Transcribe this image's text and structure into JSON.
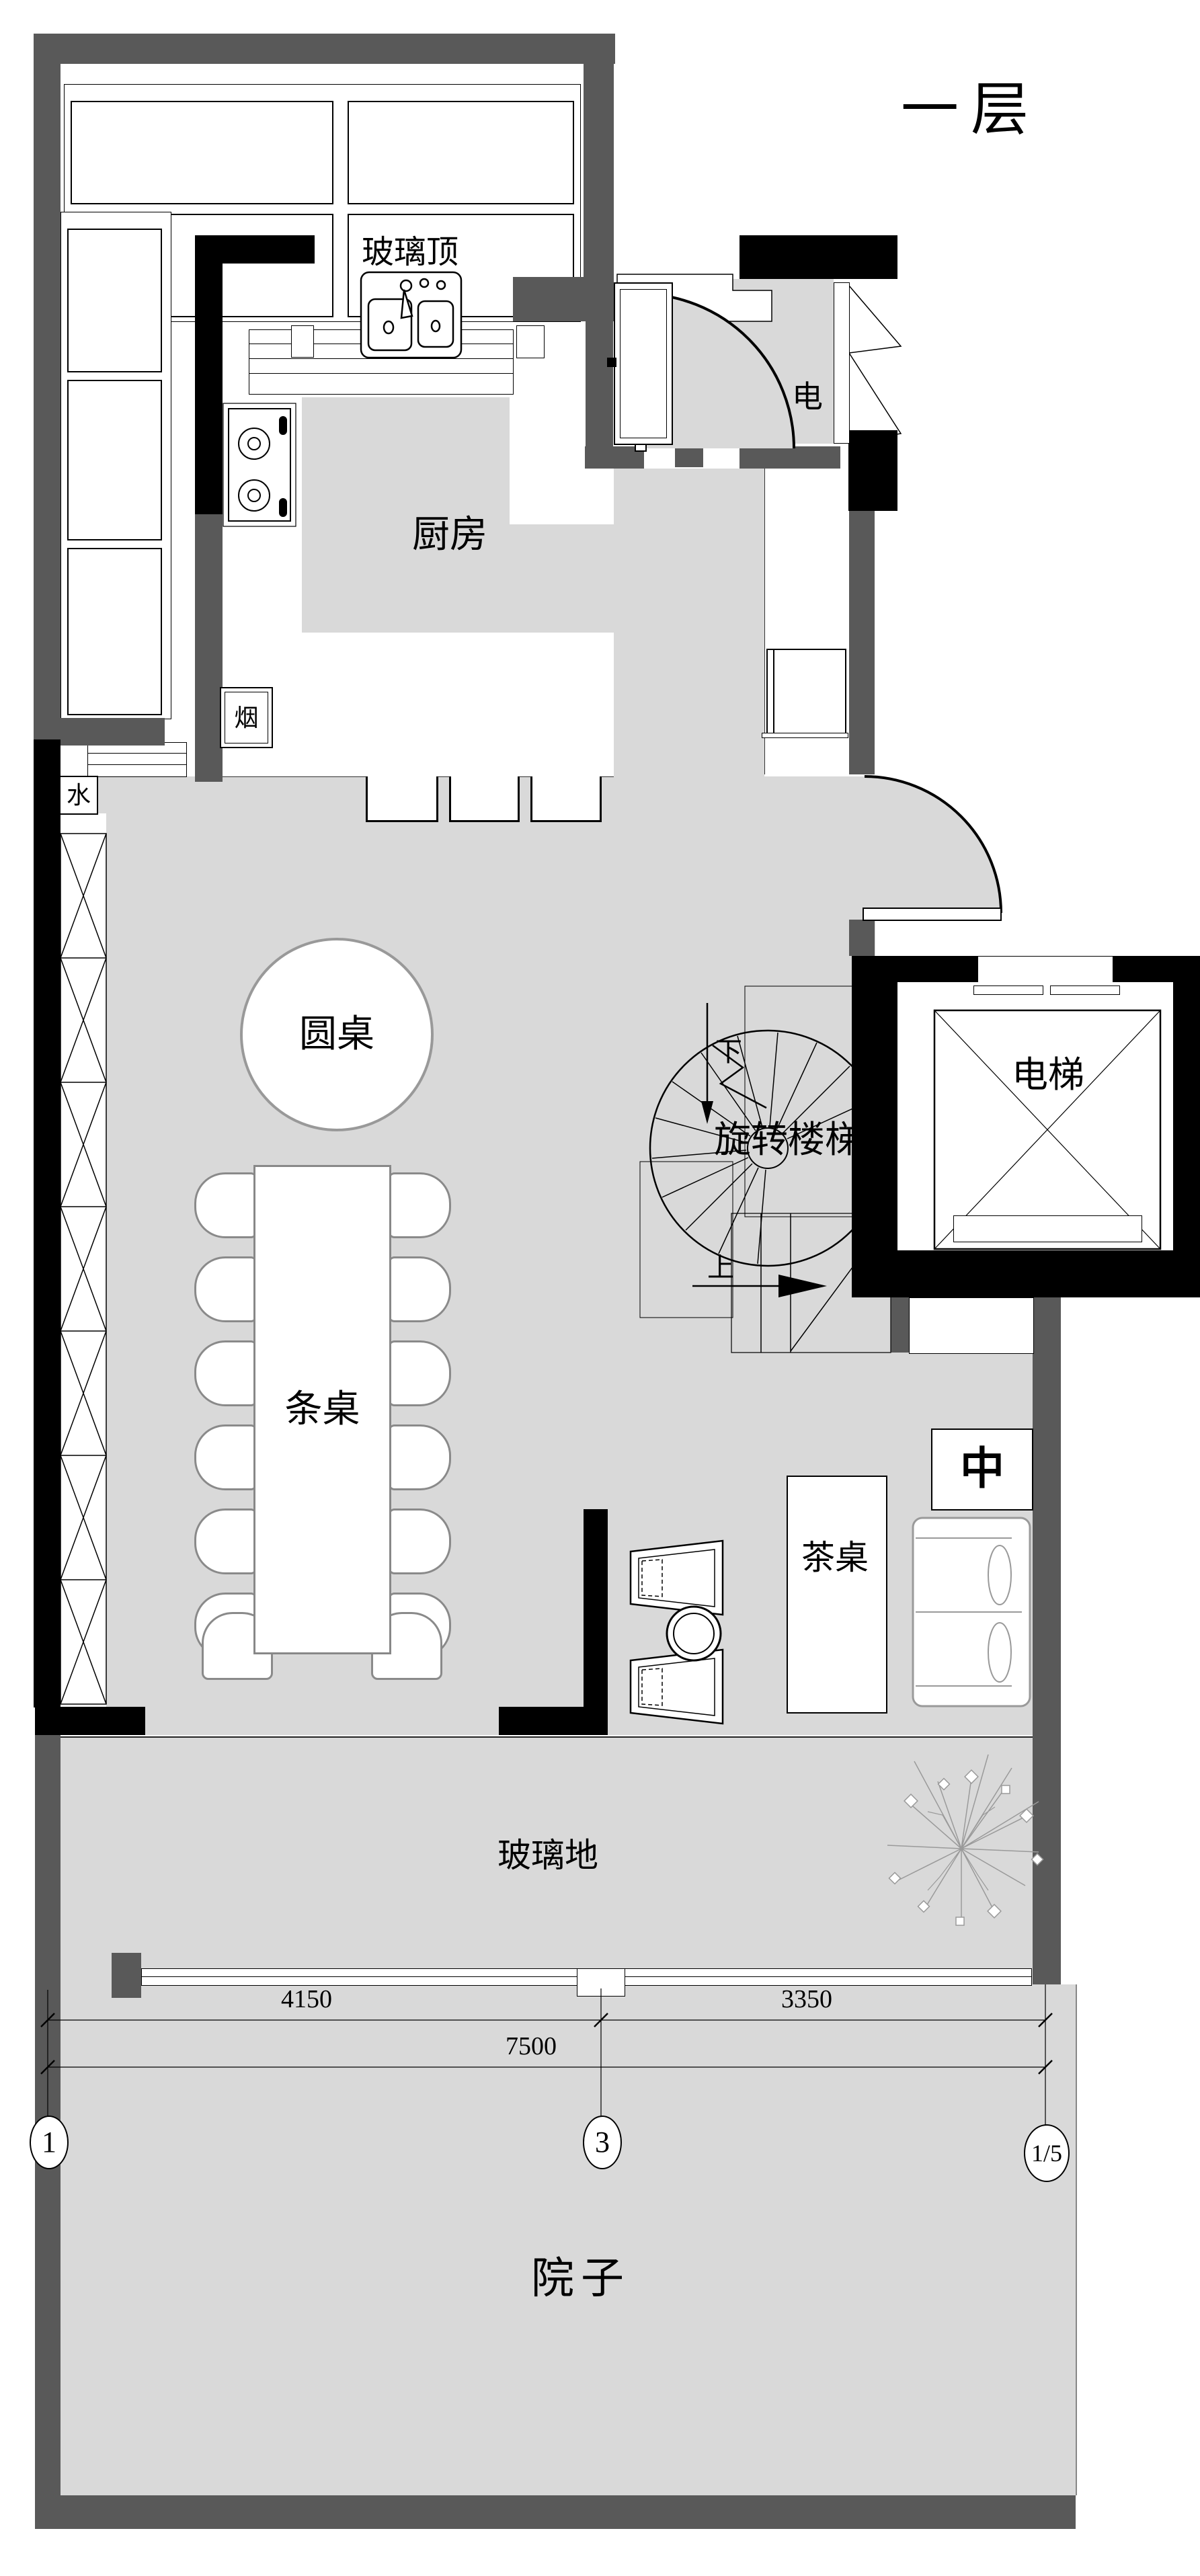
{
  "title": "一层",
  "labels": {
    "glass_roof": "玻璃顶",
    "kitchen": "厨房",
    "electric": "电",
    "smoke": "烟",
    "water": "水",
    "round_table": "圆桌",
    "long_table": "条桌",
    "tea_table": "茶桌",
    "glass_floor": "玻璃地",
    "courtyard": "院子",
    "elevator": "电梯",
    "spiral_stair": "旋转楼梯",
    "stair_up": "上",
    "stair_down": "下",
    "equipment_center": "中"
  },
  "dimensions": {
    "left_span": "4150",
    "right_span": "3350",
    "total_span": "7500"
  },
  "grid_markers": {
    "g1": "1",
    "g3": "3",
    "g15": "1/5"
  },
  "colors": {
    "wall_gray": "#595959",
    "wall_black": "#000000",
    "floor_gray": "#d9d9d9",
    "furniture_gray": "#8a8a8a"
  }
}
